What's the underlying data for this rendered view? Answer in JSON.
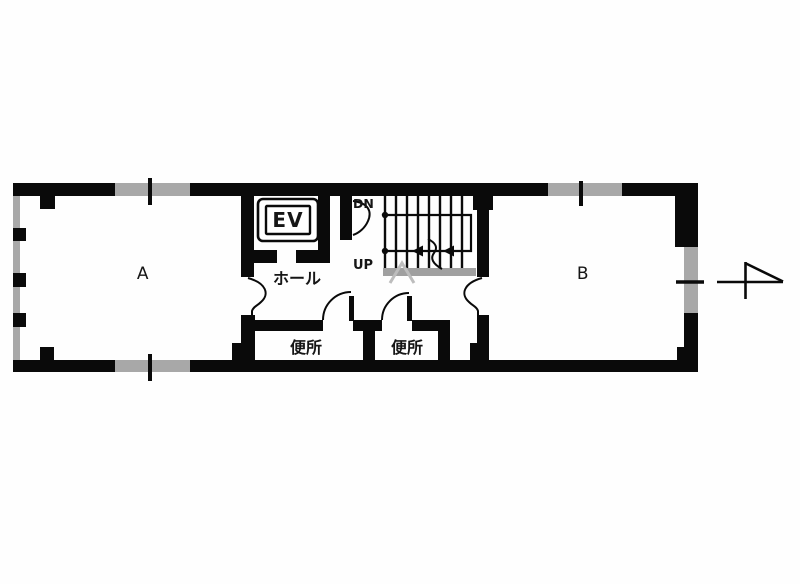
{
  "floor_plan": {
    "room_a_label": "A",
    "room_b_label": "B",
    "hall_label": "ホール",
    "toilet_left_label": "便所",
    "toilet_right_label": "便所",
    "elevator_label": "EV",
    "stair_down_label": "DN",
    "stair_up_label": "UP",
    "floor_number": "4",
    "colors": {
      "wall_black": "#0a0a0a",
      "window_gray": "#a8a8a8",
      "text": "#161616",
      "background": "#fefefe"
    }
  }
}
